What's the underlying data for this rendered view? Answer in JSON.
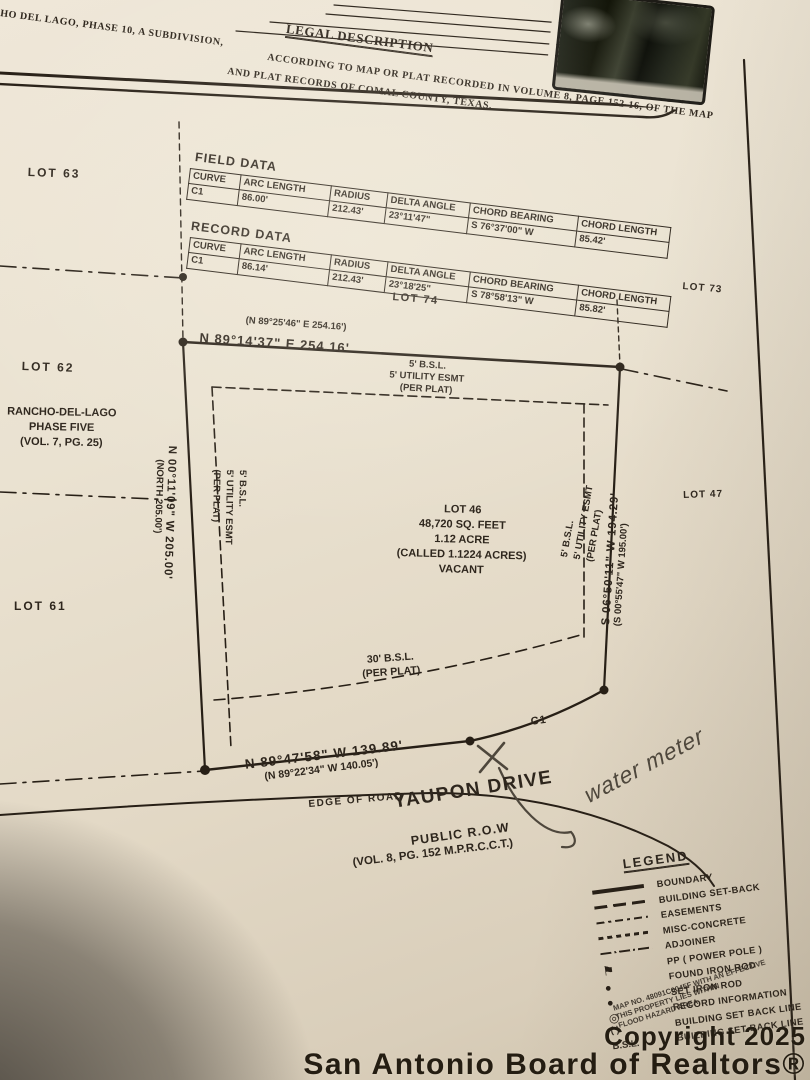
{
  "legal": {
    "heading": "LEGAL DESCRIPTION",
    "line1a": "RANCHO DEL LAGO, PHASE 10, A SUBDIVISION,",
    "line1b": "ACCORDING TO MAP OR PLAT RECORDED IN VOLUME 8, PAGE 152-16, OF THE MAP",
    "line2": "AND PLAT RECORDS OF COMAL COUNTY, TEXAS."
  },
  "field_data": {
    "title": "FIELD DATA",
    "headers": [
      "CURVE",
      "ARC LENGTH",
      "RADIUS",
      "DELTA ANGLE",
      "CHORD BEARING",
      "CHORD LENGTH"
    ],
    "rows": [
      [
        "C1",
        "86.00'",
        "212.43'",
        "23°11'47\"",
        "S 76°37'00\" W",
        "85.42'"
      ]
    ]
  },
  "record_data": {
    "title": "RECORD DATA",
    "headers": [
      "CURVE",
      "ARC LENGTH",
      "RADIUS",
      "DELTA ANGLE",
      "CHORD BEARING",
      "CHORD LENGTH"
    ],
    "rows": [
      [
        "C1",
        "86.14'",
        "212.43'",
        "23°18'25\"",
        "S 78°58'13\" W",
        "85.82'"
      ]
    ]
  },
  "lots": {
    "lot63": "LOT 63",
    "lot62": "LOT 62",
    "lot61": "LOT 61",
    "lot74": "LOT 74",
    "lot73": "LOT 73",
    "lot47": "LOT 47",
    "adjoiner_line1": "RANCHO-DEL-LAGO",
    "adjoiner_line2": "PHASE FIVE",
    "adjoiner_line3": "(VOL. 7, PG. 25)"
  },
  "bearings": {
    "north_record": "(N 89°25'46\" E   254.16')",
    "north": "N 89°14'37\" E   254.16'",
    "west": "N 00°11'09\" W   205.00'",
    "west_record": "(NORTH   205.00')",
    "east": "S 06°50'11\" W   194.29'",
    "east_record": "(S 00°55'47\" W   195.00')",
    "south": "N 89°47'58\" W   139.89'",
    "south_record": "(N 89°22'34\" W   140.05')"
  },
  "easements": {
    "top": [
      "5' B.S.L.",
      "5' UTILITY ESMT",
      "(PER PLAT)"
    ],
    "left": [
      "5' B.S.L.",
      "5' UTILITY ESMT",
      "(PER PLAT)"
    ],
    "right": [
      "5' B.S.L.",
      "5' UTILITY ESMT",
      "(PER PLAT)"
    ],
    "bottom": [
      "30' B.S.L.",
      "(PER PLAT)"
    ]
  },
  "lot_info": [
    "LOT 46",
    "48,720 SQ. FEET",
    "1.12 ACRE",
    "(CALLED 1.1224 ACRES)",
    "VACANT"
  ],
  "curve_label": "C1",
  "road": {
    "edge": "EDGE OF ROAD",
    "name": "YAUPON DRIVE",
    "row_label": "PUBLIC R.O.W",
    "vol": "(VOL. 8, PG. 152 M.P.R.C.C.T.)"
  },
  "annotation": "water meter",
  "legend": {
    "title": "LEGEND",
    "items": [
      {
        "icon": "solid-line",
        "label": "BOUNDARY"
      },
      {
        "icon": "setback-line",
        "label": "BUILDING SET-BACK"
      },
      {
        "icon": "easement-line",
        "label": "EASEMENTS"
      },
      {
        "icon": "concrete-line",
        "label": "MISC-CONCRETE"
      },
      {
        "icon": "adjoiner-line",
        "label": "ADJOINER"
      },
      {
        "icon": "power-pole",
        "label": "PP   ( POWER POLE )"
      },
      {
        "icon": "found-rod",
        "label": "FOUND IRON ROD"
      },
      {
        "icon": "set-rod",
        "label": "SET IRON ROD"
      },
      {
        "icon": "record-circle",
        "label": "RECORD INFORMATION"
      },
      {
        "icon": "none",
        "symbol_text": "(  )",
        "label": "BUILDING SET BACK LINE"
      },
      {
        "icon": "none",
        "symbol_text": "B.S.L.",
        "label": "BUILDING SET BACK LINE"
      }
    ]
  },
  "stamp": {
    "line1": "MAP NO. 48091C0045F WITH AN EFFECTIVE",
    "line2": "THIS PROPERTY LIES WITHIN",
    "line3": "FLOOD HAZARD AREA"
  },
  "watermark": {
    "line1": "Copyright 2025",
    "line2": "San Antonio Board of Realtors®"
  },
  "colors": {
    "ink": "#271f16",
    "paper": "#eae2d1",
    "pen": "#4e473c"
  }
}
